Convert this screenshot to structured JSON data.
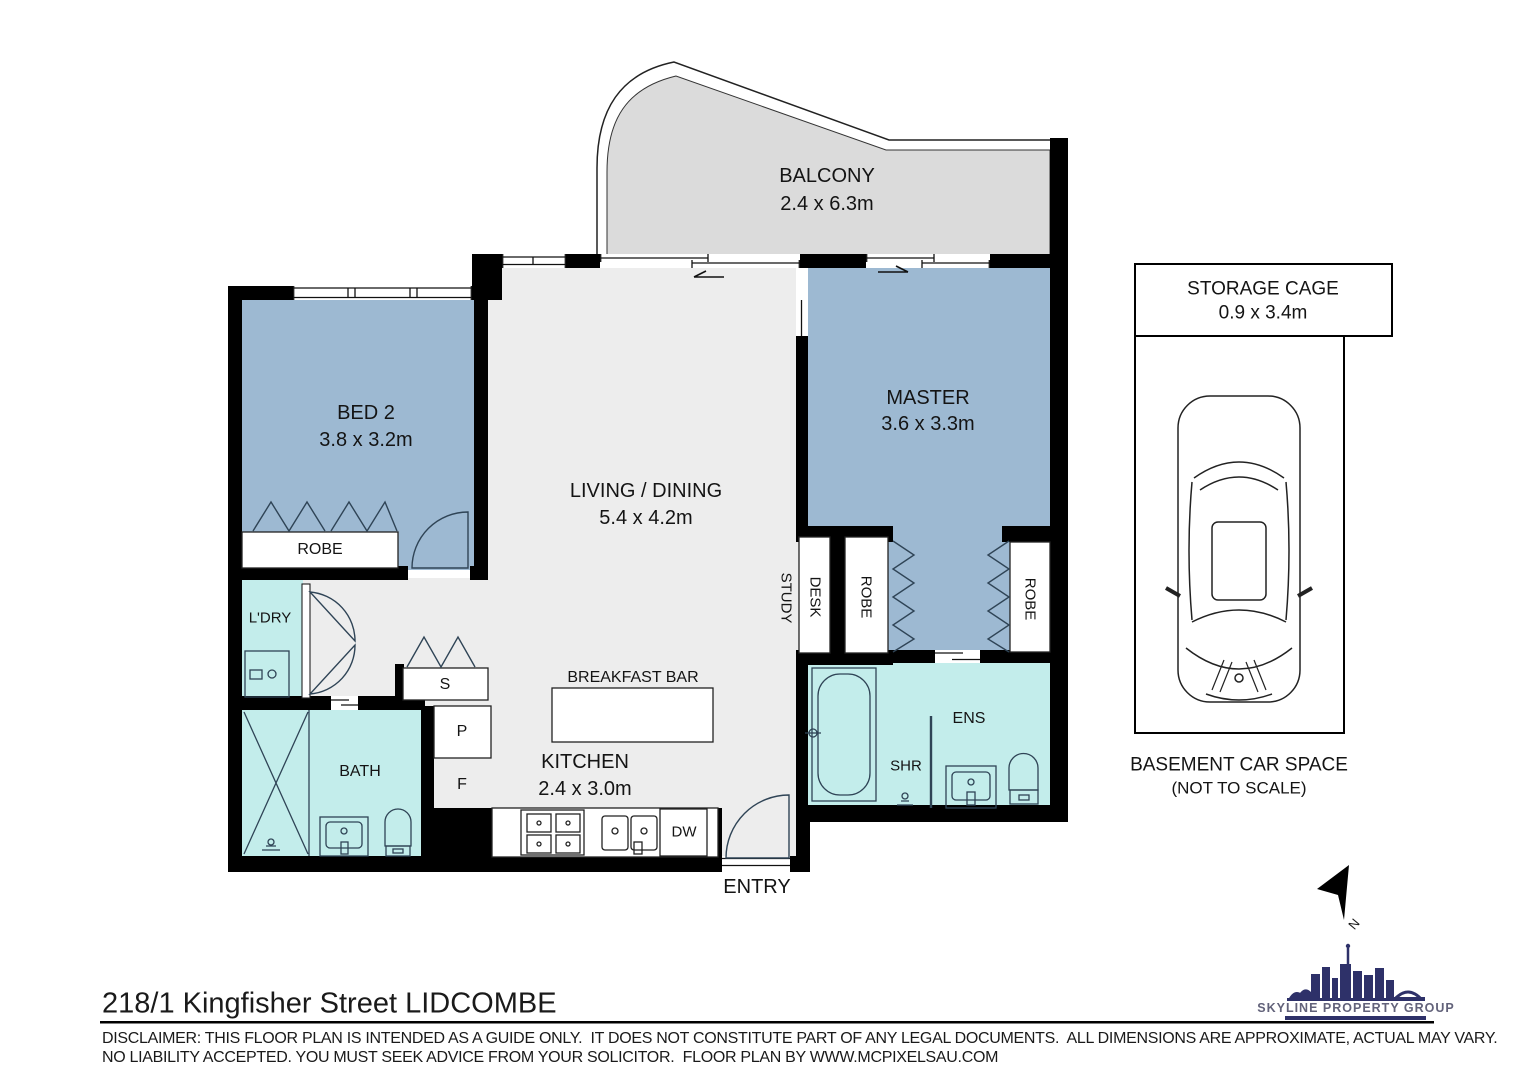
{
  "plan": {
    "balcony": {
      "name": "BALCONY",
      "dims": "2.4 x 6.3m"
    },
    "bed2": {
      "name": "BED 2",
      "dims": "3.8 x 3.2m"
    },
    "master": {
      "name": "MASTER",
      "dims": "3.6 x 3.3m"
    },
    "living": {
      "name": "LIVING / DINING",
      "dims": "5.4 x 4.2m"
    },
    "kitchen": {
      "name": "KITCHEN",
      "dims": "2.4 x 3.0m"
    },
    "labels": {
      "robe_bed2": "ROBE",
      "laundry": "L'DRY",
      "bath": "BATH",
      "cupboard_s": "S",
      "pantry_p": "P",
      "fridge_f": "F",
      "breakfast_bar": "BREAKFAST BAR",
      "study": "STUDY",
      "desk": "DESK",
      "robe_left": "ROBE",
      "robe_right": "ROBE",
      "ensuite": "ENS",
      "shower": "SHR",
      "dishwasher": "DW",
      "entry": "ENTRY"
    }
  },
  "storage_cage": {
    "name": "STORAGE CAGE",
    "dims": "0.9 x 3.4m"
  },
  "car_space": {
    "title": "BASEMENT CAR SPACE",
    "subtitle": "(NOT TO SCALE)"
  },
  "compass": {
    "label": "N"
  },
  "footer": {
    "address": "218/1 Kingfisher Street LIDCOMBE",
    "disclaimer_line1": "DISCLAIMER: THIS FLOOR PLAN IS INTENDED AS A GUIDE ONLY.  IT DOES NOT CONSTITUTE PART OF ANY LEGAL DOCUMENTS.  ALL DIMENSIONS ARE APPROXIMATE, ACTUAL MAY VARY.",
    "disclaimer_line2": "NO LIABILITY ACCEPTED. YOU MUST SEEK ADVICE FROM YOUR SOLICITOR.  FLOOR PLAN BY WWW.MCPIXELSAU.COM"
  },
  "branding": {
    "logo_text": "SKYLINE PROPERTY GROUP"
  },
  "colors": {
    "bedroom_blue": "#9db9d2",
    "wet_area_cyan": "#c3edeb",
    "floor_gray": "#ededed",
    "balcony_gray": "#dbdbdb",
    "wall_black": "#000000",
    "logo_navy": "#2e3169"
  }
}
